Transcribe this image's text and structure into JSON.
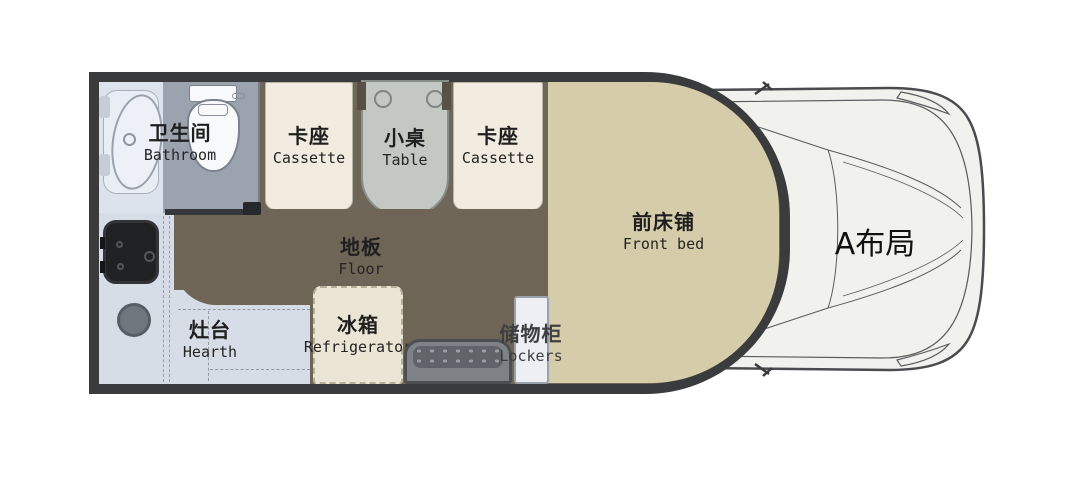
{
  "title": "A布局",
  "rooms": {
    "bathroom": {
      "zh": "卫生间",
      "en": "Bathroom"
    },
    "cassette_left": {
      "zh": "卡座",
      "en": "Cassette"
    },
    "table": {
      "zh": "小桌",
      "en": "Table"
    },
    "cassette_right": {
      "zh": "卡座",
      "en": "Cassette"
    },
    "front_bed": {
      "zh": "前床铺",
      "en": "Front bed"
    },
    "floor": {
      "zh": "地板",
      "en": "Floor"
    },
    "hearth": {
      "zh": "灶台",
      "en": "Hearth"
    },
    "refrigerator": {
      "zh": "冰箱",
      "en": "Refrigerator"
    },
    "lockers": {
      "zh": "储物柜",
      "en": "Lockers"
    }
  },
  "colors": {
    "frame": "#3a3b3d",
    "floor": "#6e6557",
    "bed": "#d5cda9",
    "seat": "#f1ecdf",
    "table": "#c3c8c3",
    "counter": "#d6dde7",
    "bathroom_light": "#dde3ed",
    "bathroom_gray": "#9ba3af",
    "fridge": "#ebe5d6",
    "cab_body": "#f1f1ed"
  }
}
